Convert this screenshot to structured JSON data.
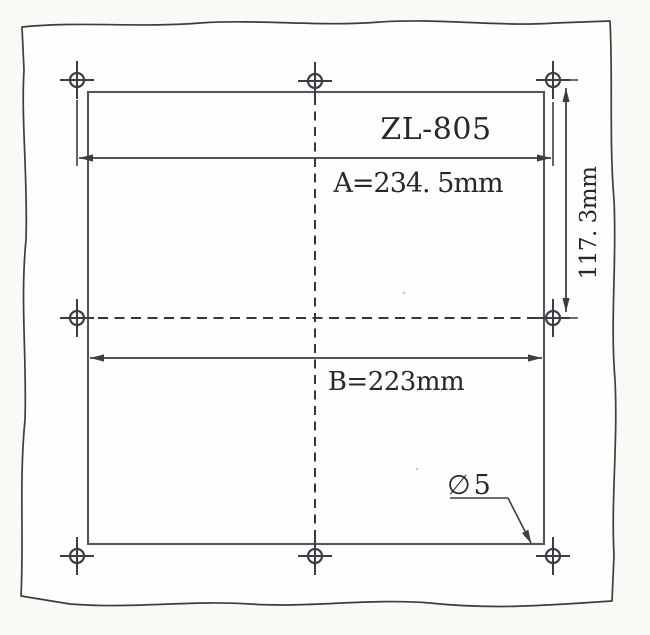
{
  "drawing_type": "panel cutout / mounting hole template",
  "labels": {
    "model": "ZL-805",
    "dim_a": "A=234. 5mm",
    "dim_b": "B=223mm",
    "dim_v": "117. 3mm",
    "hole_symbol": "∅",
    "hole_value": "5"
  },
  "values": {
    "hole_spacing_horizontal_mm": 234.5,
    "cutout_width_mm": 223,
    "hole_spacing_vertical_mm": 117.3,
    "hole_diameter_mm": 5,
    "hole_count": 8
  },
  "colors": {
    "line": "#3c3c46",
    "rect_line": "#55555e",
    "text": "#26262b",
    "dash": "#35353f",
    "paper": "#fefefd",
    "page_bg": "#faf9f6"
  }
}
